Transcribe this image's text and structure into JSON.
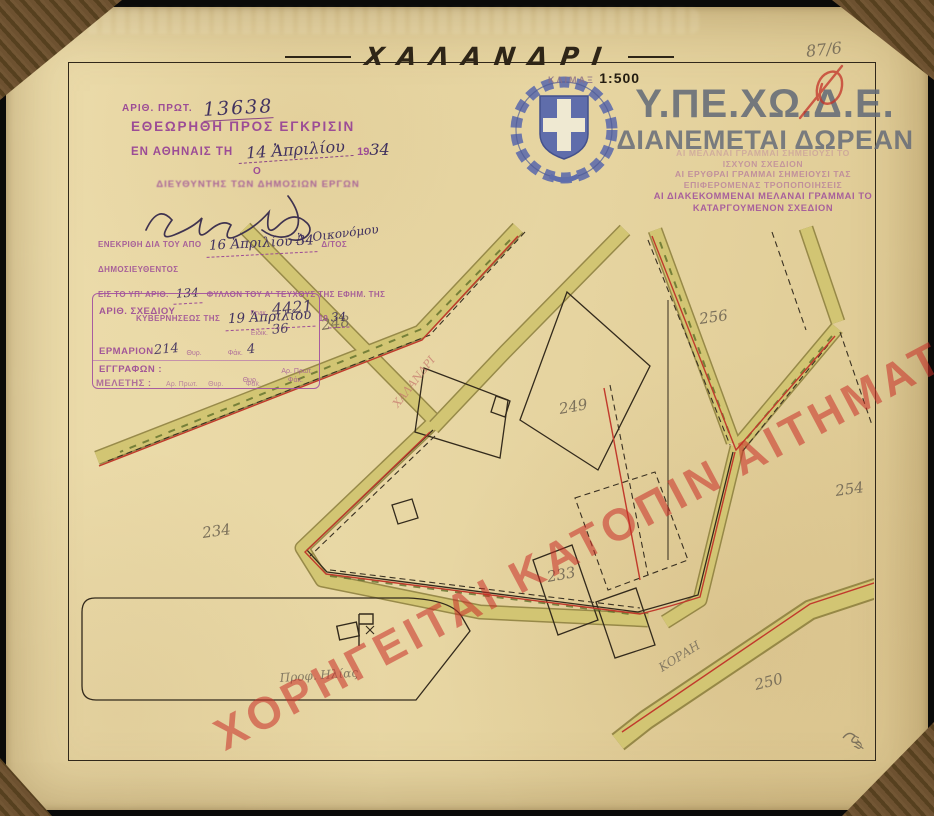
{
  "title_block": {
    "title": "ΧΑΛΑΝΔΡΙ",
    "scale_word": "ΚΛΙΜΑΞ",
    "scale_value": "1:500"
  },
  "corner_note": "87/6",
  "agency": {
    "acronym": "Υ.ΠΕ.ΧΩ.Δ.Ε.",
    "free_distribution": "ΔΙΑΝΕΜΕΤΑΙ ΔΩΡΕΑΝ"
  },
  "legend_stamp": {
    "lines": [
      "ΑΙ ΜΕΛΑΝΑΙ ΓΡΑΜΜΑΙ ΣΗΜΕΙΟΥΣΙ ΤΟ",
      "ΙΣΧΥΟΝ ΣΧΕΔΙΟΝ",
      "ΑΙ ΕΡΥΘΡΑΙ ΓΡΑΜΜΑΙ ΣΗΜΕΙΟΥΣΙ ΤΑΣ",
      "ΕΠΙΦΕΡΟΜΕΝΑΣ ΤΡΟΠΟΠΟΙΗΣΕΙΣ",
      "ΑΙ ΔΙΑΚΕΚΟΜΜΕΝΑΙ ΜΕΛΑΝΑΙ ΓΡΑΜΜΑΙ ΤΟ",
      "ΚΑΤΑΡΓΟΥΜΕΝΟΝ ΣΧΕΔΙΟΝ"
    ]
  },
  "stamps": {
    "protocol": {
      "label": "ΑΡΙΘ. ΠΡΩΤ.",
      "number": "13638"
    },
    "review": {
      "heading": "ΕΘΕΩΡΗΘΗ ΠΡΟΣ ΕΓΚΡΙΣΙΝ",
      "place_prefix": "ΕΝ ΑΘΗΝΑΙΣ ΤΗ",
      "date_handwritten": "14 Ἀπριλίου",
      "year_printed": "19",
      "year_handwritten": "34",
      "the_article": "Ο",
      "signatory": "ΔΙΕΥΘΥΝΤΗΣ ΤΩΝ ΔΗΜΟΣΙΩΝ ΕΡΓΩΝ"
    },
    "approval": {
      "line1_prefix": "ΕΝΕΚΡΙΘΗ ΔΙΑ ΤΟΥ ΑΠΟ",
      "line1_date": "16 Ἀπριλίου 34",
      "line1_suffix": "Δ/ΤΟΣ ΔΗΜΟΣΙΕΥΘΕΝΤΟΣ",
      "line2_prefix": "ΕΙΣ ΤΟ ΥΠ' ΑΡΙΘ.",
      "line2_number": "134",
      "line2_suffix": "ΦΥΛΛΟΝ ΤΟΥ Α' ΤΕΥΧΟΥΣ ΤΗΣ ΕΦΗΜ. ΤΗΣ",
      "line3_prefix": "ΚΥΒΕΡΝΗΣΕΩΣ ΤΗΣ",
      "line3_date": "19 Ἀπριλίου",
      "line3_year_printed": "19",
      "line3_year": "34",
      "signature_note": "Ἀ. Οικονόμου"
    },
    "archive_box": {
      "row1_label": "ΑΡΙΘ. ΣΧΕΔΙΟΥ",
      "row1_sub1": "Γενικ.",
      "row1_val1": "4421",
      "row1_sub2": "Ειδικ.",
      "row1_val2": "36",
      "row2_label": "ΕΡΜΑΡΙΟΝ",
      "row2_val": "214",
      "row2_sub1": "Θυρ.",
      "row2_sub2": "Φάκ.",
      "row2_val2": "4",
      "row3_label": "ΕΓΓΡΑΦΩΝ :",
      "row3_sub1": "Αρ. Πρωτ.",
      "row3_sub2": "Θυρ.",
      "row3_sub3": "Φάκ.",
      "row4_label": "ΜΕΛΕΤΗΣ :",
      "row4_sub1": "Αρ. Πρωτ.",
      "row4_sub2": "Θυρ.",
      "row4_sub3": "Φάκ."
    }
  },
  "watermark": "ΧΟΡΗΓΕΙΤΑΙ ΚΑΤΟΠΙΝ ΑΙΤΗΜΑΤΟΣ",
  "map": {
    "parcel_numbers": [
      "248",
      "249",
      "256",
      "254",
      "234",
      "233",
      "250"
    ],
    "street_annotation": "ΧΑΛΑΝΔΡΙ",
    "street_name": "ΚΟΡΑΗ",
    "landmark": "Προφ. Ηλίας",
    "corner_mark": "ψ'"
  },
  "colors": {
    "paper": "#e8d7a4",
    "street_fill": "#d2c573",
    "street_edge": "#857a38",
    "plan_line": "#332a1c",
    "revision_red": "#c13a2c",
    "stamp_purple": "#9c4c96",
    "emblem_blue": "#5f6dab",
    "watermark_red": "#c92c26"
  }
}
